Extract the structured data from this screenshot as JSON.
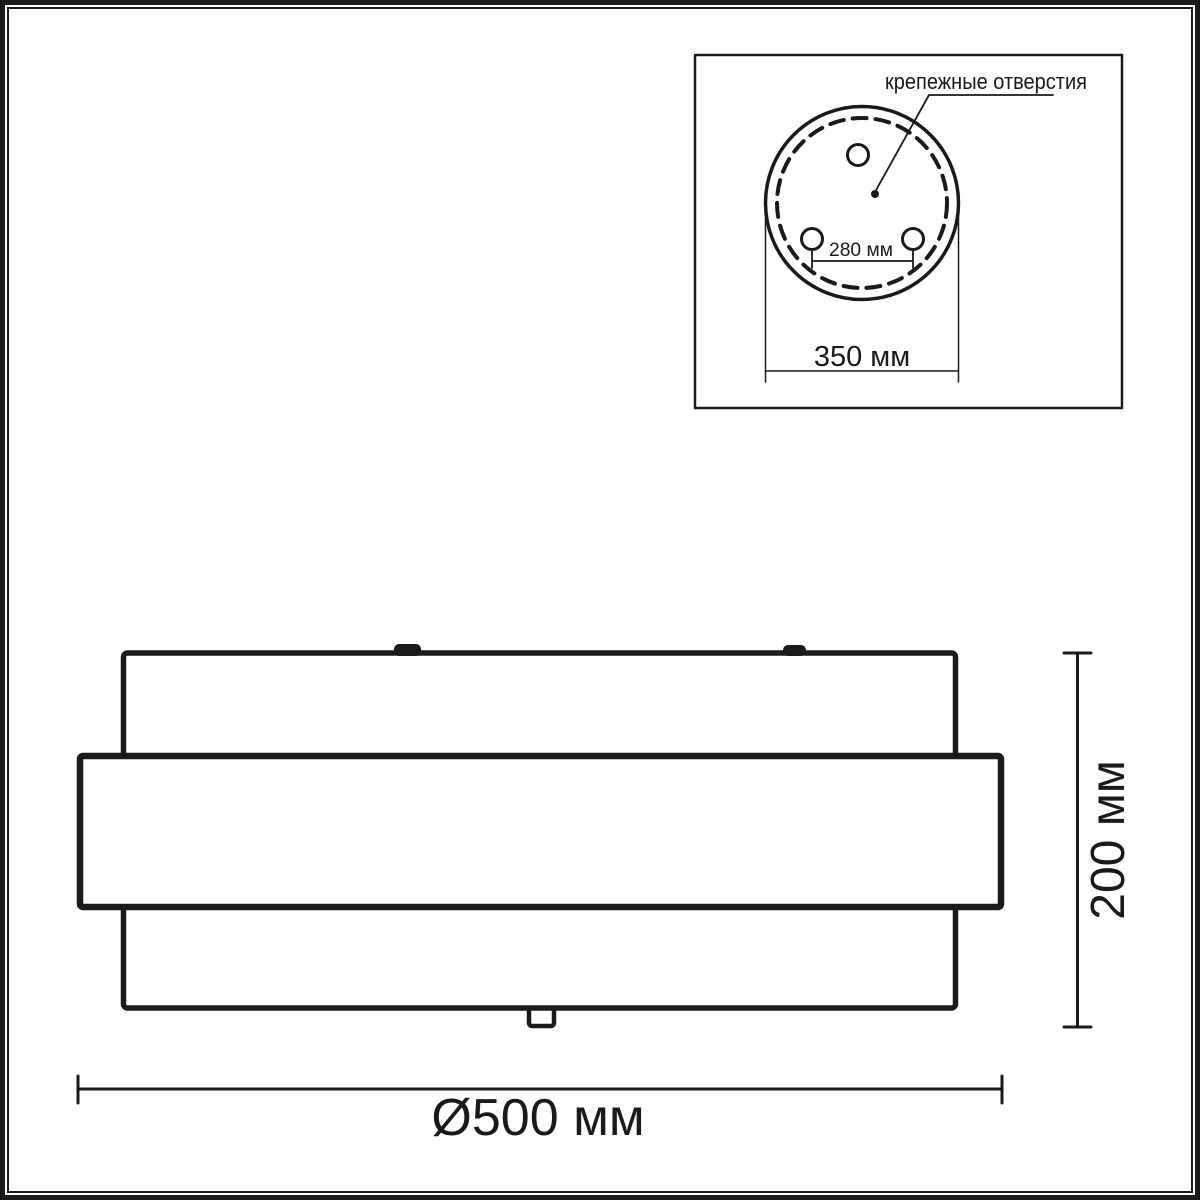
{
  "colors": {
    "line": "#1a1a1a",
    "text": "#1a1a1a",
    "background": "#ffffff"
  },
  "inset": {
    "label": "крепежные отверстия",
    "dim_holes": "280 мм",
    "dim_plate": "350 мм"
  },
  "side_view": {
    "dim_height": "200 мм",
    "dim_diameter": "Ø500 мм"
  }
}
